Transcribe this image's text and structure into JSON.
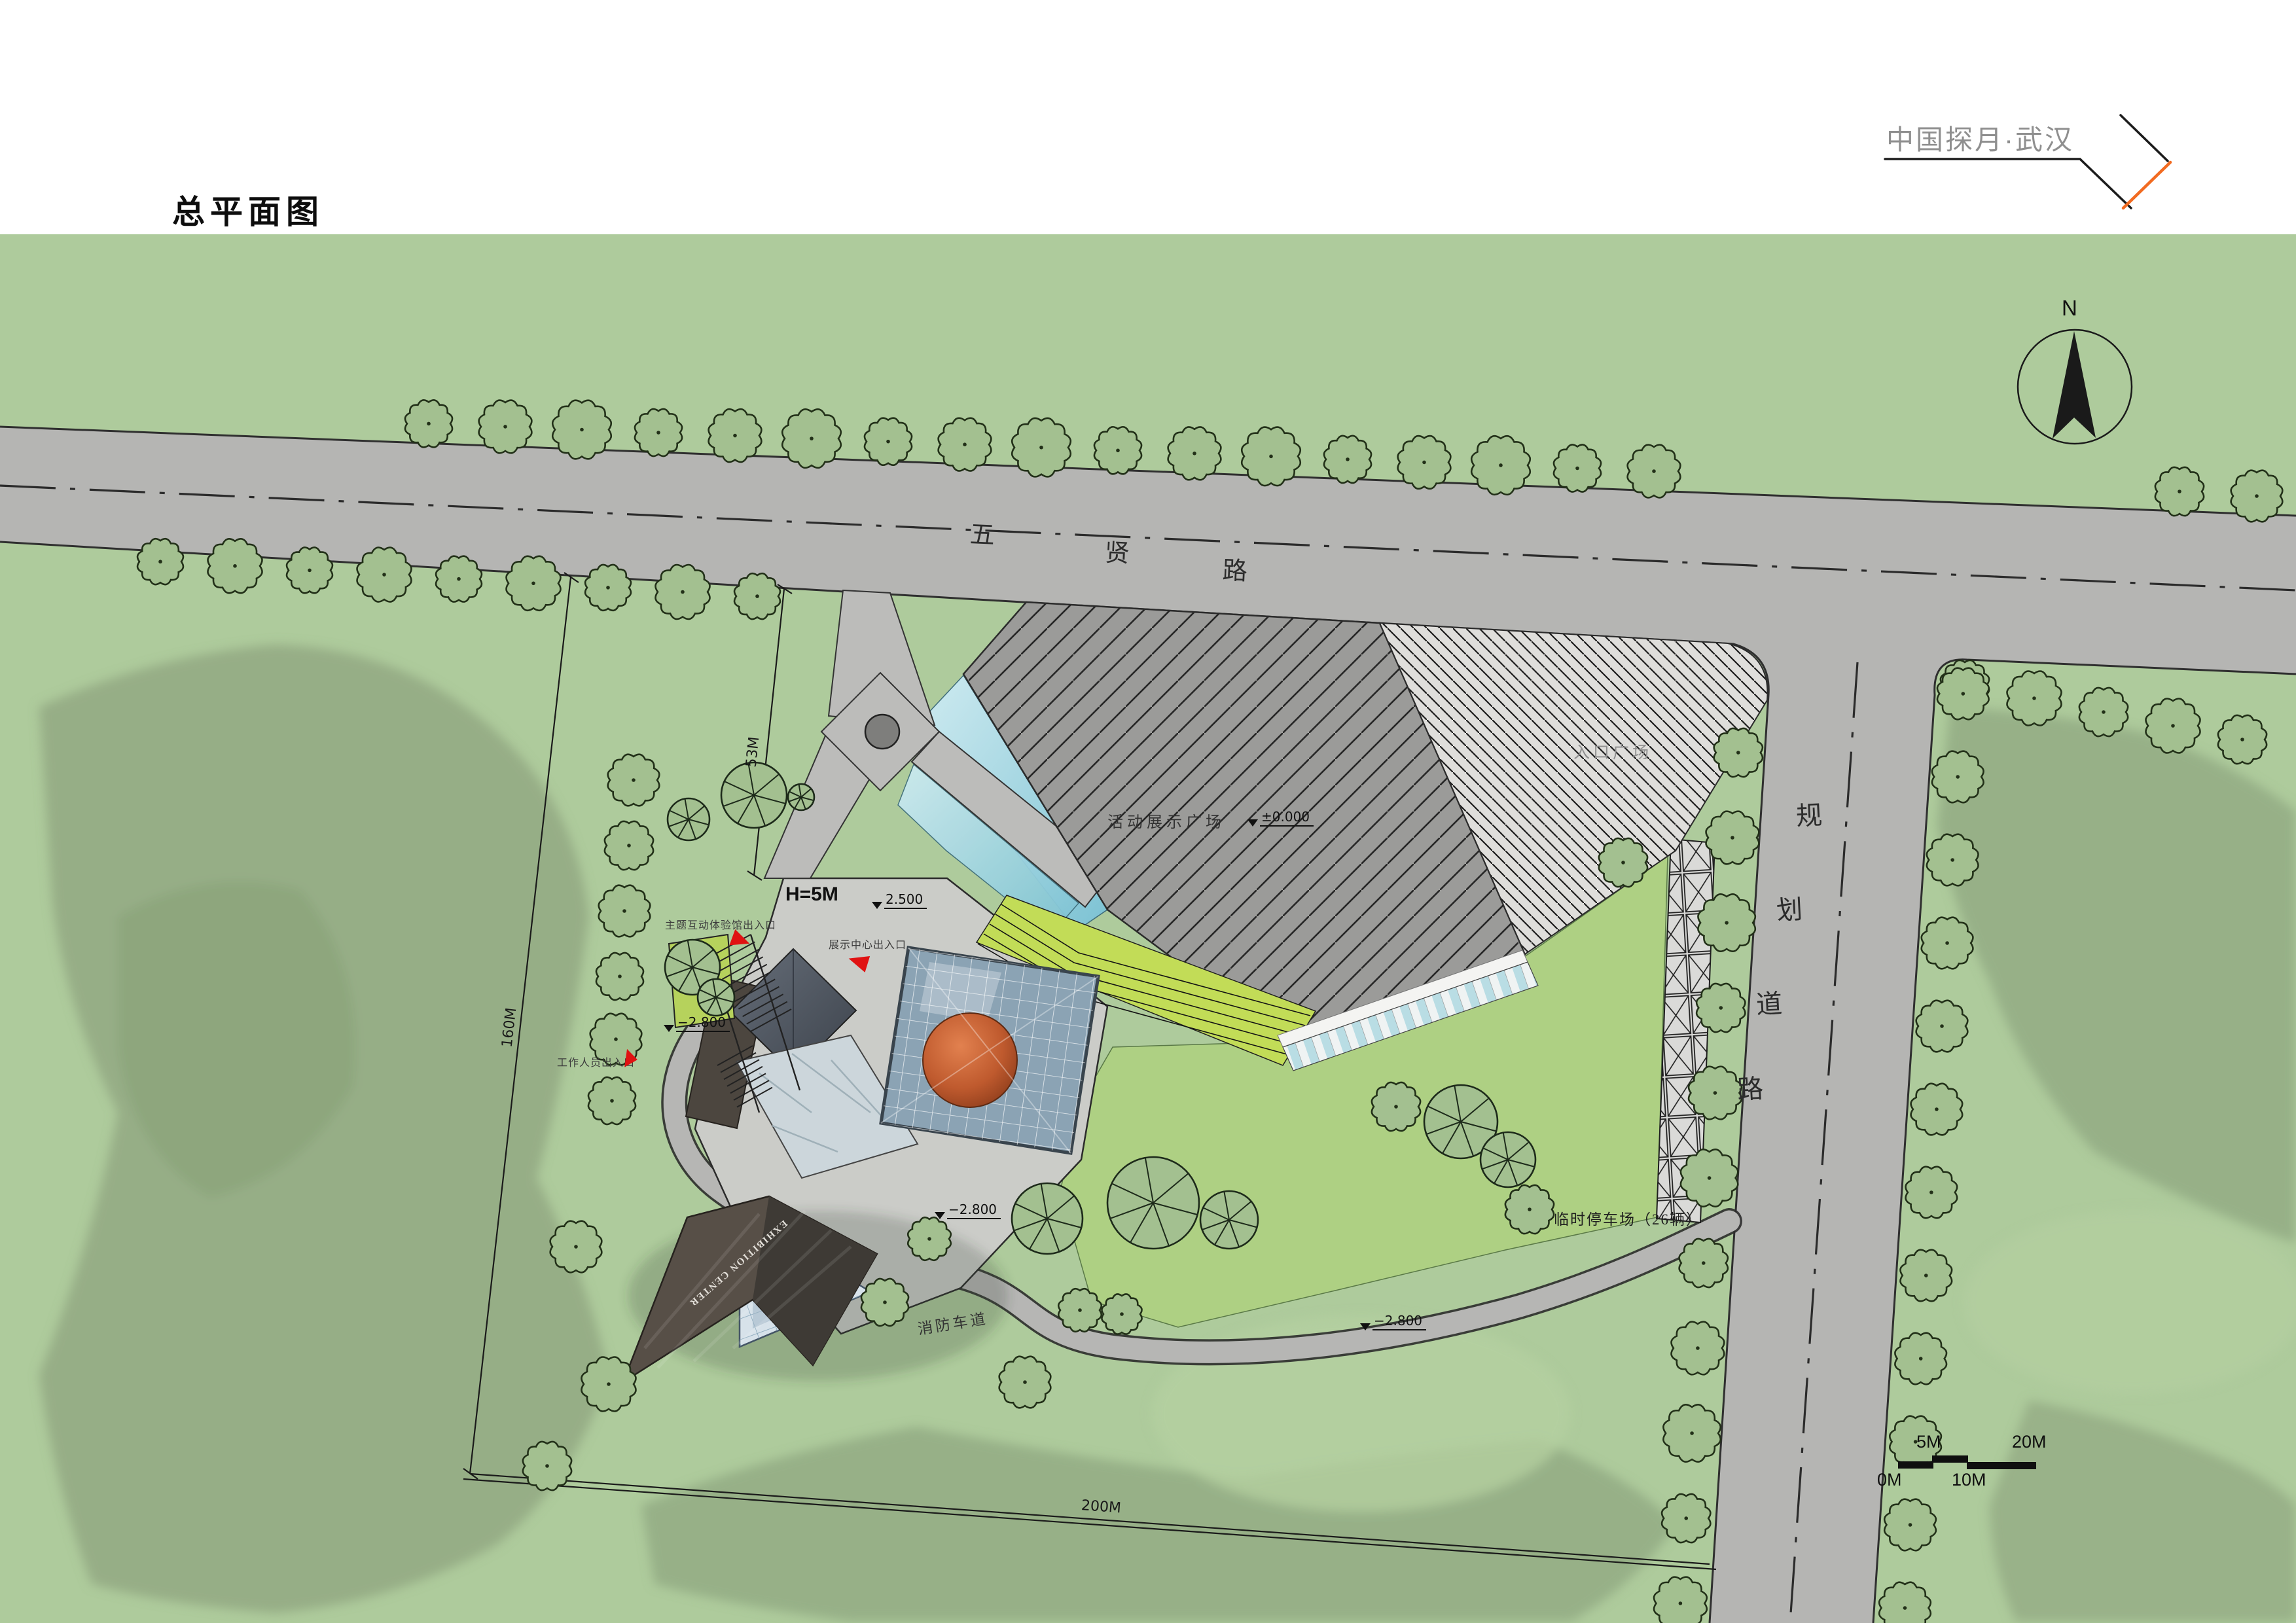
{
  "header": {
    "title": "总平面图"
  },
  "logo": {
    "text": "中国探月·武汉"
  },
  "roads": {
    "wuxian": {
      "chars": [
        "五",
        "贤",
        "路"
      ]
    },
    "planned": {
      "chars": [
        "规",
        "划",
        "道",
        "路"
      ]
    }
  },
  "site": {
    "plaza_label": "活动展示广场",
    "entry_plaza_label": "入口广场",
    "parking_label": "临时停车场（26辆）",
    "fire_lane_label": "消防车道",
    "height_note": "H=5M",
    "roof_text": "EXHIBITION CENTER"
  },
  "entrances": {
    "theme_hall": "主题互动体验馆出入口",
    "exhibition_center": "展示中心出入口",
    "staff": "工作人员出入口"
  },
  "elevations": {
    "zero": "±0.000",
    "plus_2500": "2.500",
    "minus_2800": "−2.800"
  },
  "dimensions": {
    "west": "160M",
    "north": "53M",
    "south": "200M"
  },
  "compass": {
    "label": "N"
  },
  "scale_bar": {
    "m0": "0M",
    "m5": "5M",
    "m10": "10M",
    "m20": "20M"
  },
  "colors": {
    "accent_orange": "#f26b21",
    "entrance_marker_red": "#e01212",
    "water_blue": "#9fd3de",
    "terrace_lime": "#b5d545",
    "lawn_green": "#aed083",
    "road_gray": "#b5b5b3",
    "site_green": "#aecb9c",
    "plaza_gray": "#9b9b99"
  }
}
